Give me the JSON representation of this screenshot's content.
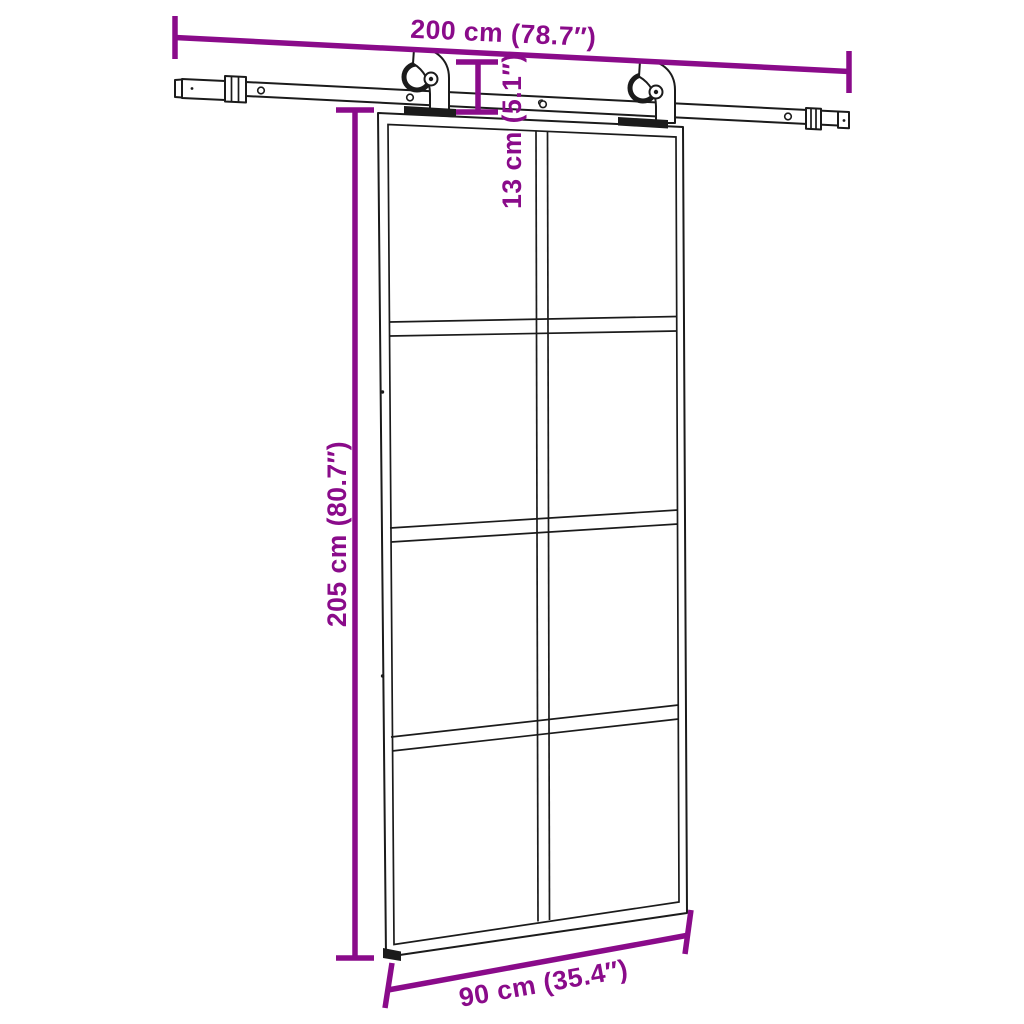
{
  "colors": {
    "accent": "#8A0B8A",
    "line": "#1B1B1B",
    "background": "#FFFFFF"
  },
  "dimensions": {
    "rail_width": {
      "label": "200 cm (78.7″)"
    },
    "hanger_drop": {
      "label": "13 cm (5.1″)"
    },
    "door_height": {
      "label": "205 cm (80.7″)"
    },
    "door_width": {
      "label": "90 cm (35.4″)"
    }
  },
  "figure": {
    "glass_columns": 2,
    "glass_rows": 4
  }
}
